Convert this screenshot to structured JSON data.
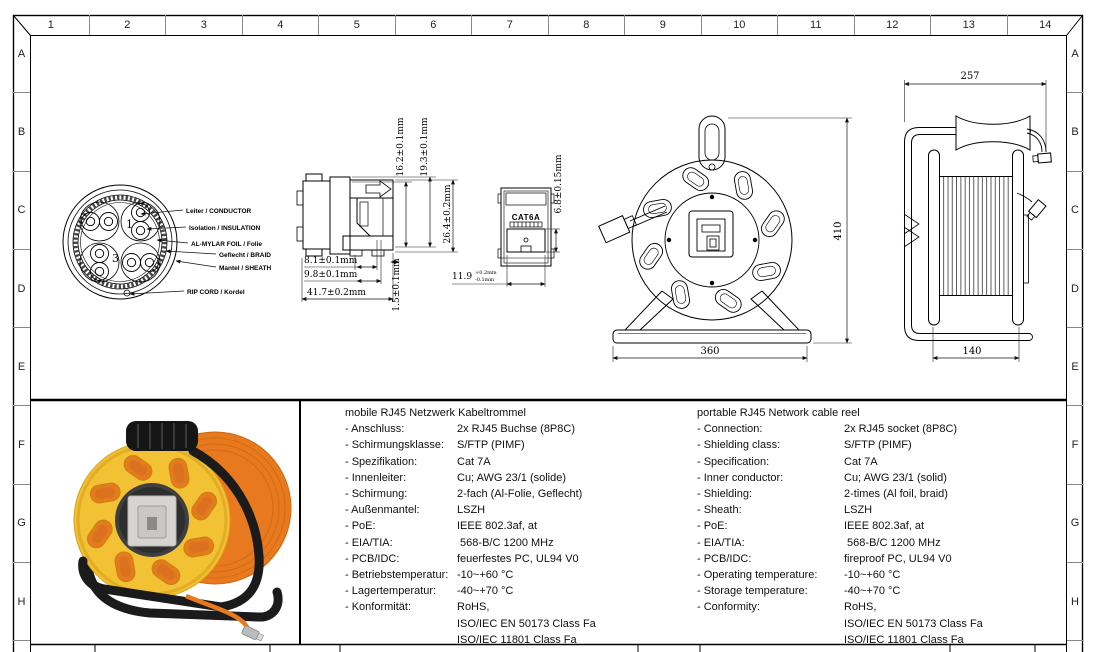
{
  "sheet": {
    "grid_cols": [
      "1",
      "2",
      "3",
      "4",
      "5",
      "6",
      "7",
      "8",
      "9",
      "10",
      "11",
      "12",
      "13",
      "14"
    ],
    "grid_rows": [
      "A",
      "B",
      "C",
      "D",
      "E",
      "F",
      "G",
      "H"
    ]
  },
  "cross_section": {
    "labels": [
      "Leiter / CONDUCTOR",
      "Isolation / INSULATION",
      "AL-MYLAR FOIL / Folie",
      "Geflecht / BRAID",
      "Mantel / SHEATH",
      "RIP CORD / Kordel"
    ],
    "pair_numbers": [
      "1",
      "3"
    ]
  },
  "jack_side_dims": {
    "h1": "16.2±0.1mm",
    "h2": "19.3±0.1mm",
    "h3": "26.4±0.2mm",
    "w1": "8.1±0.1mm",
    "w2": "9.8±0.1mm",
    "w3": "41.7±0.2mm",
    "w4": "1.5±0.1mm"
  },
  "jack_front": {
    "marking": "CAT6A",
    "height_dim": "6.8±0.15mm",
    "width_dim": "11.9",
    "width_tol_plus": "+0.2mm",
    "width_tol_minus": "-0.1mm"
  },
  "reel_front_dims": {
    "width": "360",
    "height": "410"
  },
  "reel_side_dims": {
    "overall_width": "257",
    "drum_width": "140"
  },
  "specs_de": {
    "title": "mobile RJ45 Netzwerk Kabeltrommel",
    "rows": [
      {
        "label": "- Anschluss:",
        "value": "2x RJ45 Buchse (8P8C)"
      },
      {
        "label": "- Schirmungsklasse:",
        "value": "S/FTP (PIMF)"
      },
      {
        "label": "- Spezifikation:",
        "value": "Cat 7A"
      },
      {
        "label": "- Innenleiter:",
        "value": "Cu; AWG 23/1 (solide)"
      },
      {
        "label": "- Schirmung:",
        "value": "2-fach (Al-Folie, Geflecht)"
      },
      {
        "label": "- Außenmantel:",
        "value": "LSZH"
      },
      {
        "label": "- PoE:",
        "value": "IEEE 802.3af, at"
      },
      {
        "label": "- EIA/TIA:",
        "value": " 568-B/C 1200 MHz"
      },
      {
        "label": "- PCB/IDC:",
        "value": "feuerfestes PC, UL94 V0"
      },
      {
        "label": "- Betriebstemperatur:",
        "value": "-10~+60 °C"
      },
      {
        "label": "- Lagertemperatur:",
        "value": "-40~+70 °C"
      },
      {
        "label": "- Konformität:",
        "value": "RoHS,"
      },
      {
        "label": "",
        "value": "ISO/IEC EN 50173 Class Fa"
      },
      {
        "label": "",
        "value": "ISO/IEC 11801 Class Fa"
      }
    ]
  },
  "specs_en": {
    "title": "portable RJ45 Network cable reel",
    "rows": [
      {
        "label": "- Connection:",
        "value": "2x RJ45 socket (8P8C)"
      },
      {
        "label": "- Shielding class:",
        "value": "S/FTP (PIMF)"
      },
      {
        "label": "- Specification:",
        "value": "Cat 7A"
      },
      {
        "label": "- Inner conductor:",
        "value": "Cu; AWG 23/1 (solid)"
      },
      {
        "label": "- Shielding:",
        "value": "2-times (Al foil, braid)"
      },
      {
        "label": "- Sheath:",
        "value": "LSZH"
      },
      {
        "label": "- PoE:",
        "value": "IEEE 802.3af, at"
      },
      {
        "label": "- EIA/TIA:",
        "value": " 568-B/C 1200 MHz"
      },
      {
        "label": "- PCB/IDC:",
        "value": "fireproof PC, UL94 V0"
      },
      {
        "label": "- Operating temperature:",
        "value": "-10~+60 °C"
      },
      {
        "label": "- Storage temperature:",
        "value": "-40~+70 °C"
      },
      {
        "label": "- Conformity:",
        "value": "RoHS,"
      },
      {
        "label": "",
        "value": "ISO/IEC EN 50173 Class Fa"
      },
      {
        "label": "",
        "value": "ISO/IEC 11801 Class Fa"
      }
    ]
  },
  "photo": {
    "colors": {
      "reel_yellow": "#f2c134",
      "cable_orange": "#e8791f",
      "cable_orange_dark": "#cf6d13",
      "frame_black": "#1b1b1b",
      "panel_gray": "#d6d5d1"
    }
  }
}
